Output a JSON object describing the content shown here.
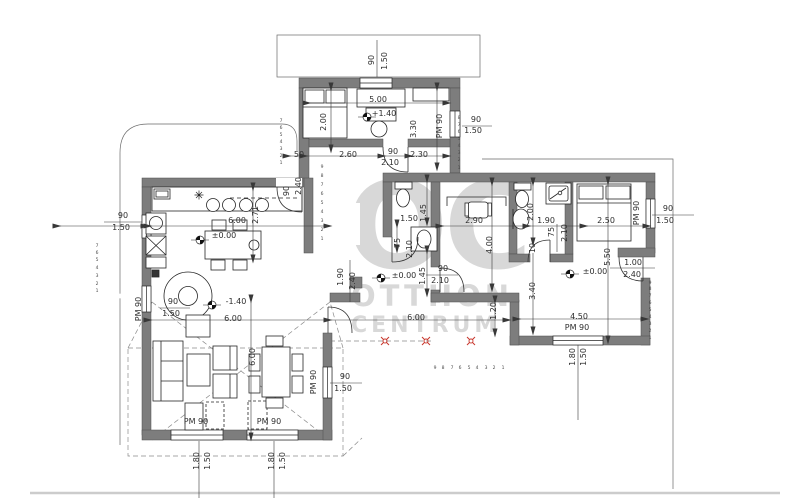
{
  "watermark": {
    "line1": "OC",
    "line2": "OTTHON",
    "line3": "CENTRUM"
  },
  "colors": {
    "wall": "#7d7d7d",
    "wall_edge": "#4f4f4f",
    "line": "#262626",
    "dim": "#383838",
    "watermark": "#d2d2d2",
    "marker_red": "#c8372d",
    "page_line": "#cccccc"
  },
  "labels": [
    {
      "t": "90",
      "x": 372,
      "y": 60,
      "r": -90
    },
    {
      "t": "1.50",
      "x": 385,
      "y": 61,
      "r": -90
    },
    {
      "t": "5.00",
      "x": 378,
      "y": 100,
      "r": 0
    },
    {
      "t": "2.00",
      "x": 324,
      "y": 122,
      "r": -90
    },
    {
      "t": "+1.40",
      "x": 384,
      "y": 114,
      "r": 0
    },
    {
      "t": "3.30",
      "x": 414,
      "y": 129,
      "r": -90
    },
    {
      "t": "PM 90",
      "x": 440,
      "y": 126,
      "r": -90
    },
    {
      "t": "90",
      "x": 476,
      "y": 120,
      "r": 0
    },
    {
      "t": "1.50",
      "x": 473,
      "y": 131,
      "r": 0
    },
    {
      "t": "50",
      "x": 299,
      "y": 155,
      "r": 0
    },
    {
      "t": "2.60",
      "x": 348,
      "y": 155,
      "r": 0
    },
    {
      "t": "90",
      "x": 393,
      "y": 152,
      "r": 0
    },
    {
      "t": "2.10",
      "x": 390,
      "y": 163,
      "r": 0
    },
    {
      "t": "2.30",
      "x": 419,
      "y": 155,
      "r": 0
    },
    {
      "t": "90",
      "x": 287,
      "y": 191,
      "r": -90
    },
    {
      "t": "2.40",
      "x": 299,
      "y": 186,
      "r": -90
    },
    {
      "t": "90",
      "x": 123,
      "y": 216,
      "r": 0
    },
    {
      "t": "1.50",
      "x": 121,
      "y": 228,
      "r": 0
    },
    {
      "t": "6.00",
      "x": 237,
      "y": 221,
      "r": 0
    },
    {
      "t": "±0.00",
      "x": 224,
      "y": 236,
      "r": 0
    },
    {
      "t": "2.71",
      "x": 256,
      "y": 215,
      "r": -90
    },
    {
      "t": "90",
      "x": 173,
      "y": 302,
      "r": 0
    },
    {
      "t": "1.50",
      "x": 171,
      "y": 314,
      "r": 0
    },
    {
      "t": "-1.40",
      "x": 236,
      "y": 302,
      "r": 0
    },
    {
      "t": "PM 90",
      "x": 139,
      "y": 309,
      "r": -90
    },
    {
      "t": "6.00",
      "x": 233,
      "y": 319,
      "r": 0
    },
    {
      "t": "6.00",
      "x": 253,
      "y": 357,
      "r": -90
    },
    {
      "t": "1.50",
      "x": 409,
      "y": 219,
      "r": 0
    },
    {
      "t": "1.45",
      "x": 424,
      "y": 213,
      "r": -90
    },
    {
      "t": "75",
      "x": 398,
      "y": 243,
      "r": -90
    },
    {
      "t": "2.10",
      "x": 410,
      "y": 249,
      "r": -90
    },
    {
      "t": "1.45",
      "x": 423,
      "y": 276,
      "r": -90
    },
    {
      "t": "90",
      "x": 443,
      "y": 269,
      "r": 0
    },
    {
      "t": "2.10",
      "x": 440,
      "y": 281,
      "r": 0
    },
    {
      "t": "±0.00",
      "x": 404,
      "y": 276,
      "r": 0
    },
    {
      "t": "1.90",
      "x": 341,
      "y": 277,
      "r": -90
    },
    {
      "t": "2.40",
      "x": 353,
      "y": 281,
      "r": -90
    },
    {
      "t": "6.00",
      "x": 416,
      "y": 318,
      "r": 0
    },
    {
      "t": "1.20",
      "x": 494,
      "y": 311,
      "r": -90
    },
    {
      "t": "2.90",
      "x": 474,
      "y": 221,
      "r": 0
    },
    {
      "t": "4.00",
      "x": 490,
      "y": 245,
      "r": -90
    },
    {
      "t": "2.00",
      "x": 531,
      "y": 212,
      "r": -90
    },
    {
      "t": "1.90",
      "x": 546,
      "y": 221,
      "r": 0
    },
    {
      "t": "75",
      "x": 552,
      "y": 232,
      "r": -90
    },
    {
      "t": "2.10",
      "x": 565,
      "y": 233,
      "r": -90
    },
    {
      "t": "2.50",
      "x": 606,
      "y": 221,
      "r": 0
    },
    {
      "t": "PM 90",
      "x": 637,
      "y": 213,
      "r": -90
    },
    {
      "t": "90",
      "x": 668,
      "y": 209,
      "r": 0
    },
    {
      "t": "1.50",
      "x": 665,
      "y": 221,
      "r": 0
    },
    {
      "t": "5.50",
      "x": 608,
      "y": 257,
      "r": -90
    },
    {
      "t": "10",
      "x": 533,
      "y": 248,
      "r": -90
    },
    {
      "t": "3.40",
      "x": 533,
      "y": 291,
      "r": -90
    },
    {
      "t": "±0.00",
      "x": 595,
      "y": 272,
      "r": 0
    },
    {
      "t": "1.00",
      "x": 633,
      "y": 263,
      "r": 0
    },
    {
      "t": "2.40",
      "x": 632,
      "y": 275,
      "r": 0
    },
    {
      "t": "4.50",
      "x": 579,
      "y": 317,
      "r": 0
    },
    {
      "t": "PM 90",
      "x": 577,
      "y": 328,
      "r": 0
    },
    {
      "t": "1.80",
      "x": 573,
      "y": 357,
      "r": -90
    },
    {
      "t": "1.50",
      "x": 584,
      "y": 357,
      "r": -90
    },
    {
      "t": "90",
      "x": 345,
      "y": 377,
      "r": 0
    },
    {
      "t": "1.50",
      "x": 343,
      "y": 389,
      "r": 0
    },
    {
      "t": "PM 90",
      "x": 314,
      "y": 382,
      "r": -90
    },
    {
      "t": "PM 90",
      "x": 196,
      "y": 422,
      "r": 0
    },
    {
      "t": "PM 90",
      "x": 269,
      "y": 422,
      "r": 0
    },
    {
      "t": "1.80",
      "x": 197,
      "y": 461,
      "r": -90
    },
    {
      "t": "1.50",
      "x": 208,
      "y": 461,
      "r": -90
    },
    {
      "t": "1.80",
      "x": 272,
      "y": 461,
      "r": -90
    },
    {
      "t": "1.50",
      "x": 283,
      "y": 461,
      "r": -90
    },
    {
      "t": "1",
      "x": 97,
      "y": 292,
      "r": 0,
      "s": "xs"
    },
    {
      "t": "2",
      "x": 97,
      "y": 285,
      "r": 0,
      "s": "xs"
    },
    {
      "t": "3",
      "x": 97,
      "y": 277,
      "r": 0,
      "s": "xs"
    },
    {
      "t": "4",
      "x": 97,
      "y": 269,
      "r": 0,
      "s": "xs"
    },
    {
      "t": "5",
      "x": 97,
      "y": 261,
      "r": 0,
      "s": "xs"
    },
    {
      "t": "6",
      "x": 97,
      "y": 254,
      "r": 0,
      "s": "xs"
    },
    {
      "t": "7",
      "x": 97,
      "y": 247,
      "r": 0,
      "s": "xs"
    },
    {
      "t": "1",
      "x": 650,
      "y": 339,
      "r": 0,
      "s": "xs"
    },
    {
      "t": "2",
      "x": 650,
      "y": 332,
      "r": 0,
      "s": "xs"
    },
    {
      "t": "3",
      "x": 650,
      "y": 325,
      "r": 0,
      "s": "xs"
    },
    {
      "t": "4",
      "x": 650,
      "y": 318,
      "r": 0,
      "s": "xs"
    },
    {
      "t": "5",
      "x": 650,
      "y": 311,
      "r": 0,
      "s": "xs"
    },
    {
      "t": "6",
      "x": 650,
      "y": 304,
      "r": 0,
      "s": "xs"
    },
    {
      "t": "7",
      "x": 650,
      "y": 297,
      "r": 0,
      "s": "xs"
    },
    {
      "t": "8",
      "x": 650,
      "y": 290,
      "r": 0,
      "s": "xs"
    },
    {
      "t": "9",
      "x": 650,
      "y": 284,
      "r": 0,
      "s": "xs"
    },
    {
      "t": "1",
      "x": 503,
      "y": 369,
      "r": 0,
      "s": "xs"
    },
    {
      "t": "2",
      "x": 494,
      "y": 369,
      "r": 0,
      "s": "xs"
    },
    {
      "t": "3",
      "x": 486,
      "y": 369,
      "r": 0,
      "s": "xs"
    },
    {
      "t": "4",
      "x": 477,
      "y": 369,
      "r": 0,
      "s": "xs"
    },
    {
      "t": "5",
      "x": 469,
      "y": 369,
      "r": 0,
      "s": "xs"
    },
    {
      "t": "6",
      "x": 460,
      "y": 369,
      "r": 0,
      "s": "xs"
    },
    {
      "t": "7",
      "x": 452,
      "y": 369,
      "r": 0,
      "s": "xs"
    },
    {
      "t": "8",
      "x": 443,
      "y": 369,
      "r": 0,
      "s": "xs"
    },
    {
      "t": "9",
      "x": 435,
      "y": 369,
      "r": 0,
      "s": "xs"
    },
    {
      "t": "1",
      "x": 281,
      "y": 164,
      "r": 0,
      "s": "xs"
    },
    {
      "t": "2",
      "x": 281,
      "y": 157,
      "r": 0,
      "s": "xs"
    },
    {
      "t": "3",
      "x": 281,
      "y": 150,
      "r": 0,
      "s": "xs"
    },
    {
      "t": "4",
      "x": 281,
      "y": 143,
      "r": 0,
      "s": "xs"
    },
    {
      "t": "5",
      "x": 281,
      "y": 136,
      "r": 0,
      "s": "xs"
    },
    {
      "t": "6",
      "x": 281,
      "y": 129,
      "r": 0,
      "s": "xs"
    },
    {
      "t": "7",
      "x": 281,
      "y": 122,
      "r": 0,
      "s": "xs"
    },
    {
      "t": "1",
      "x": 459,
      "y": 169,
      "r": 0,
      "s": "xs"
    },
    {
      "t": "2",
      "x": 459,
      "y": 161,
      "r": 0,
      "s": "xs"
    },
    {
      "t": "3",
      "x": 459,
      "y": 154,
      "r": 0,
      "s": "xs"
    },
    {
      "t": "4",
      "x": 459,
      "y": 147,
      "r": 0,
      "s": "xs"
    },
    {
      "t": "5",
      "x": 459,
      "y": 140,
      "r": 0,
      "s": "xs"
    },
    {
      "t": "6",
      "x": 459,
      "y": 133,
      "r": 0,
      "s": "xs"
    },
    {
      "t": "7",
      "x": 459,
      "y": 126,
      "r": 0,
      "s": "xs"
    },
    {
      "t": "8",
      "x": 459,
      "y": 119,
      "r": 0,
      "s": "xs"
    },
    {
      "t": "1",
      "x": 322,
      "y": 240,
      "r": 0,
      "s": "xs"
    },
    {
      "t": "2",
      "x": 322,
      "y": 231,
      "r": 0,
      "s": "xs"
    },
    {
      "t": "3",
      "x": 322,
      "y": 222,
      "r": 0,
      "s": "xs"
    },
    {
      "t": "4",
      "x": 322,
      "y": 213,
      "r": 0,
      "s": "xs"
    },
    {
      "t": "5",
      "x": 322,
      "y": 204,
      "r": 0,
      "s": "xs"
    },
    {
      "t": "6",
      "x": 322,
      "y": 195,
      "r": 0,
      "s": "xs"
    },
    {
      "t": "7",
      "x": 322,
      "y": 186,
      "r": 0,
      "s": "xs"
    },
    {
      "t": "8",
      "x": 322,
      "y": 177,
      "r": 0,
      "s": "xs"
    },
    {
      "t": "9",
      "x": 322,
      "y": 168,
      "r": 0,
      "s": "xs"
    }
  ]
}
